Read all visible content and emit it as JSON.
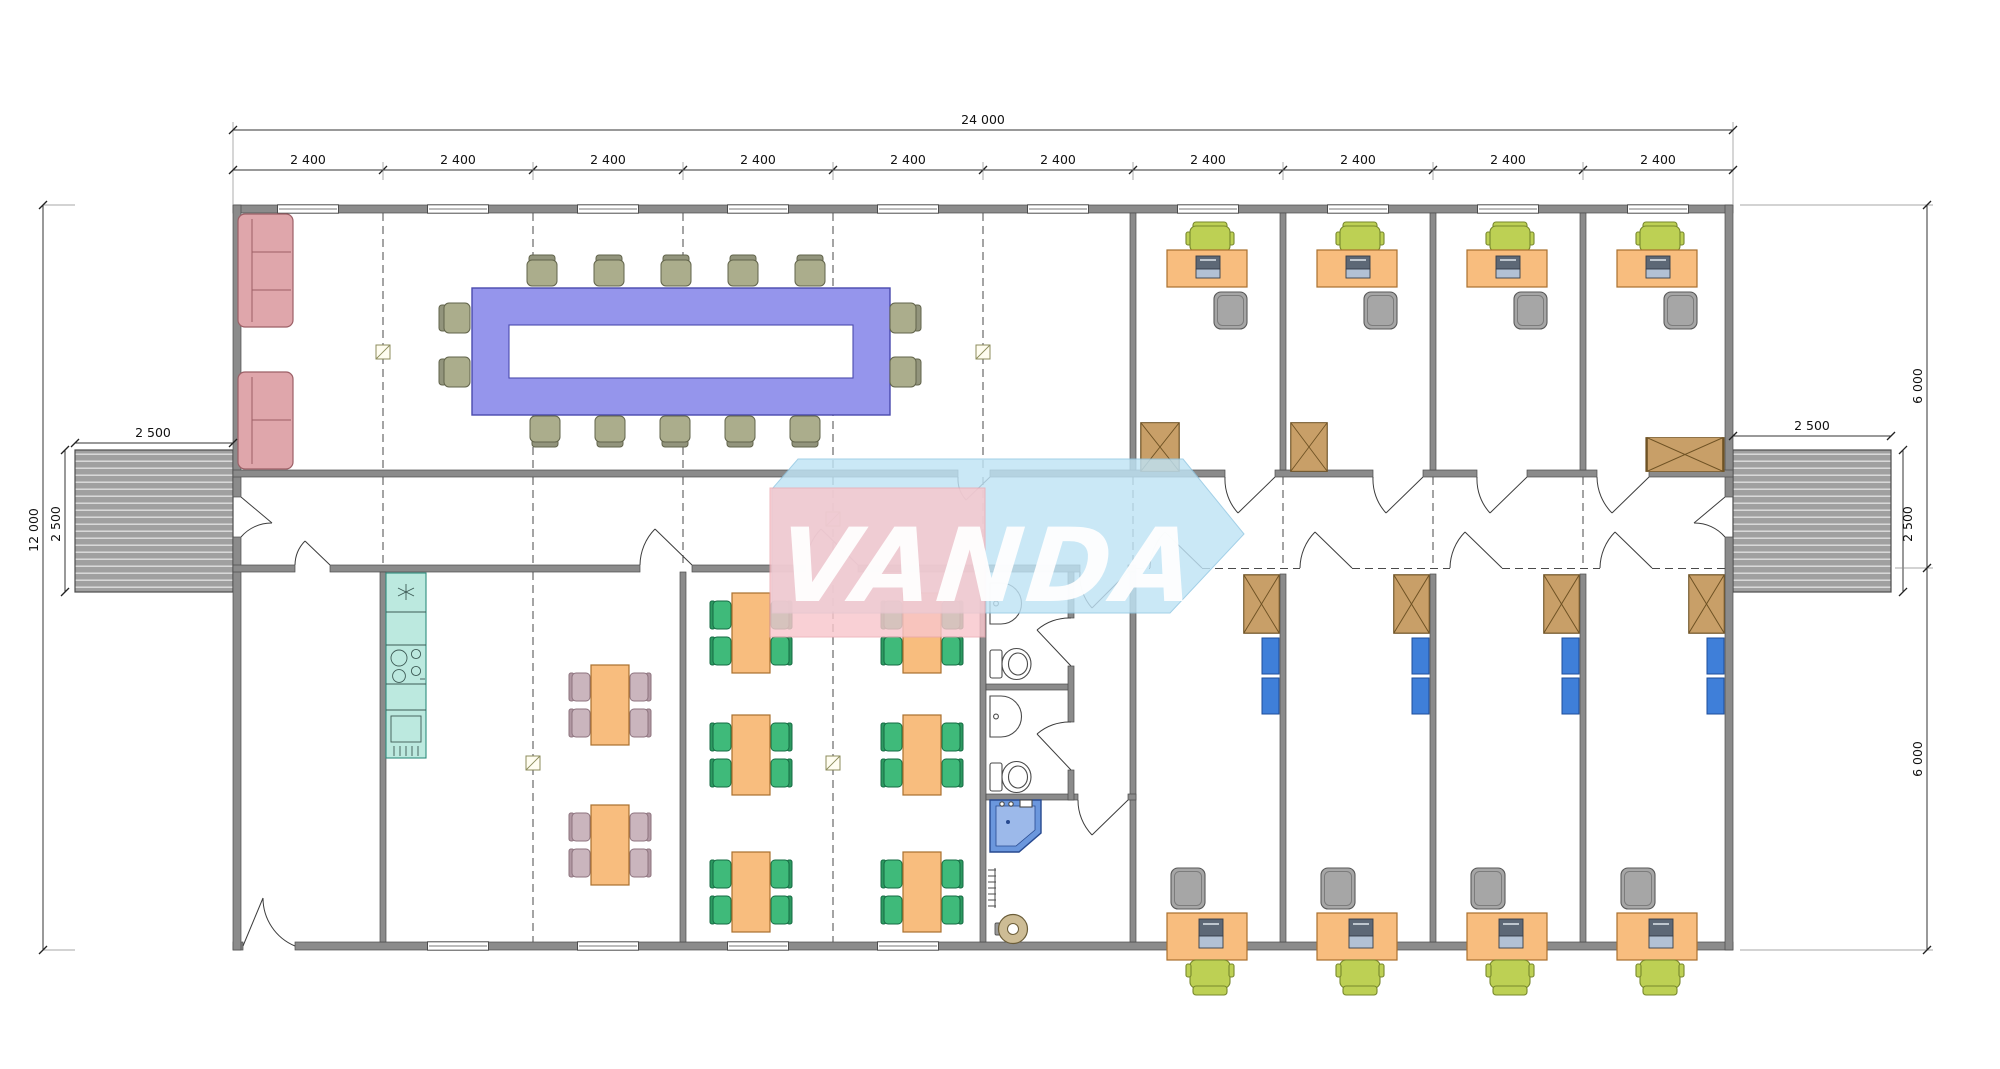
{
  "watermark": {
    "text": "VANDA",
    "pink_color": "#f8c6cc",
    "blue_color": "#bfe3f5",
    "text_color": "#ffffff"
  },
  "dimensions": {
    "overall_width": "24 000",
    "module_width": "2 400",
    "module_count": 10,
    "overall_height": "12 000",
    "ramp_width": "2 500",
    "ramp_depth": "2 500",
    "upper_section_height": "6 000",
    "lower_section_height": "6 000"
  },
  "plan": {
    "type": "modular-office-building-floor-plan",
    "rooms": [
      {
        "name": "meeting-room",
        "furniture": [
          "u-shaped-conference-table",
          "14-conference-chairs",
          "2-sofas"
        ]
      },
      {
        "name": "office-top",
        "count": 4,
        "furniture": [
          "desk",
          "printer",
          "task-chair",
          "guest-chair",
          "wardrobe"
        ]
      },
      {
        "name": "office-bottom",
        "count": 4,
        "furniture": [
          "desk",
          "printer",
          "task-chair",
          "guest-chair",
          "wardrobe",
          "blue-lockers"
        ]
      },
      {
        "name": "entry-room",
        "furniture": []
      },
      {
        "name": "kitchen-dining",
        "furniture": [
          "kitchenette-with-stove-and-fridge",
          "2-tables-4-mauve-chairs"
        ]
      },
      {
        "name": "canteen",
        "furniture": [
          "6-tables-4-green-chairs-each"
        ]
      },
      {
        "name": "sanitary-block",
        "furniture": [
          "2-wc-with-washbasin",
          "shower-cabin",
          "water-heater",
          "radiator"
        ]
      },
      {
        "name": "corridor",
        "furniture": []
      },
      {
        "name": "entrance-ramp",
        "count": 2
      }
    ],
    "colors": {
      "walls": "#8b8b8b",
      "conference_table": "#9595ec",
      "desks_tables": "#f8bd7e",
      "task_chair": "#bdd054",
      "canteen_chair": "#3fba7a",
      "dining_chair": "#cab5bd",
      "conference_chair": "#abad8c",
      "sofa": "#dfa6ab",
      "kitchen": "#bce9df",
      "wardrobe": "#c89f68",
      "locker": "#3f7fd9",
      "shower": "#6b97dd"
    }
  }
}
